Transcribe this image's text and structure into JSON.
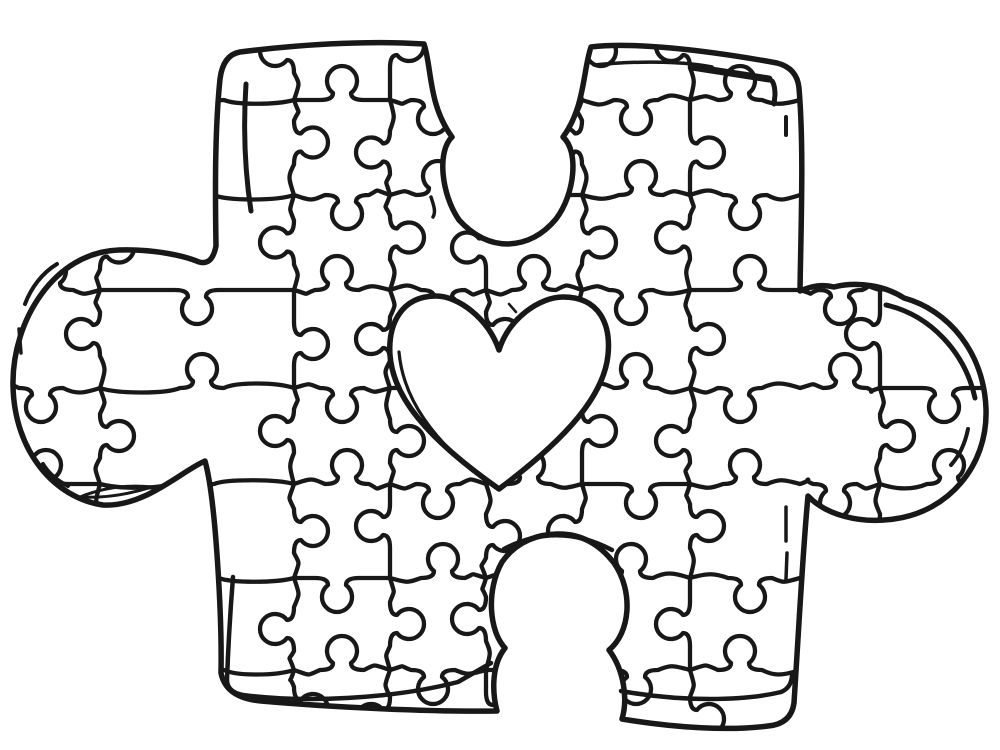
{
  "page": {
    "background_color": "#ffffff",
    "ink_color": "#181818",
    "artwork_alt": "Coloring page line drawing: one large jigsaw puzzle piece composed of small interlocking puzzle pieces with a blank heart shape at its center"
  },
  "grid": {
    "row_line_positions": [
      100,
      195,
      290,
      388,
      484,
      578,
      670
    ],
    "column_line_positions": [
      100,
      294,
      390,
      486,
      582,
      690,
      880
    ],
    "horizontal_cell_boundaries": [
      -8,
      100,
      294,
      390,
      486,
      582,
      690,
      800,
      880,
      1008
    ],
    "vertical_cell_boundaries": [
      -8,
      100,
      195,
      290,
      388,
      484,
      578,
      670,
      758
    ],
    "knob_radius": 15,
    "knob_neck_half_width": 9,
    "knob_neck_depth": 7,
    "line_width": 4.3
  },
  "shapes": {
    "outline_width": 5.5,
    "heart_width": 5.5,
    "heart_inner_line_width": 3.2,
    "heart_filled": false,
    "elements": [
      "puzzle-piece-outline",
      "left-knob",
      "right-knob",
      "top-notch",
      "bottom-notch",
      "jigsaw-grid",
      "heart-outline",
      "inner-highlight-lines"
    ]
  }
}
